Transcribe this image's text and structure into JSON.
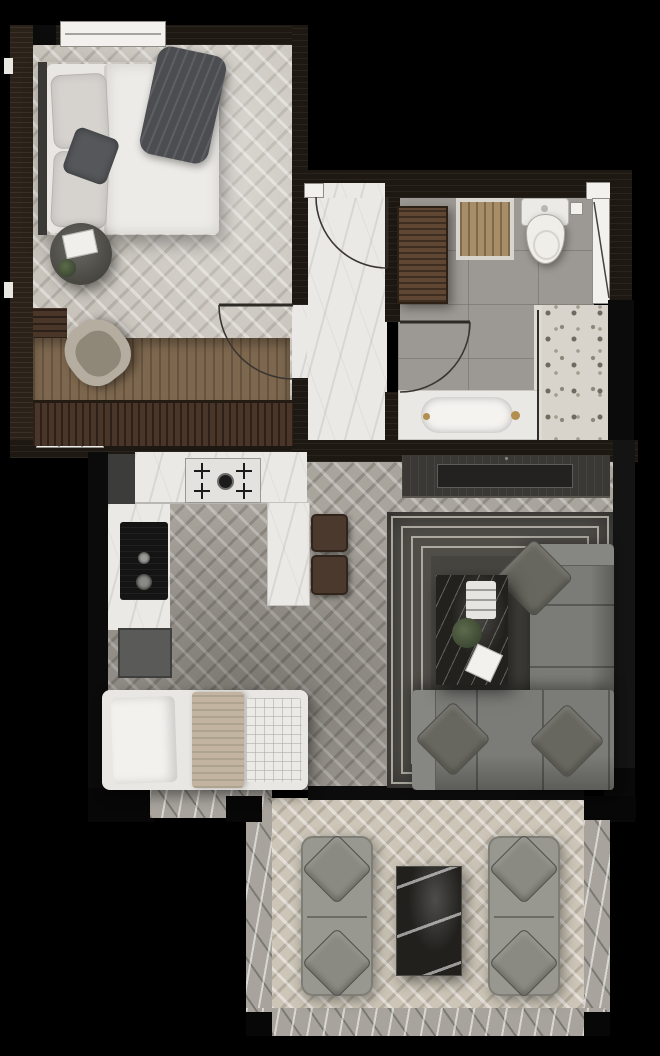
{
  "canvas": {
    "width": 660,
    "height": 1056
  },
  "plan_type": "apartment-floor-plan-top-view",
  "colors": {
    "background": "#000000",
    "wall": "#1e1813",
    "wall_black": "#0b0b0b",
    "floor_bedroom": "#c8c3bb",
    "floor_living": "#a9a49c",
    "floor_balcony": "#cdc6b8",
    "marble_white": "#eae9e6",
    "marble_grey": "#a8a49d",
    "tile_grey": "#9c9893",
    "terrazzo": "#d8d4cc",
    "wood_dark": "#4a3628",
    "wood_mid": "#5f4734",
    "wood_light": "#7d674e",
    "bed_white": "#e9e7e3",
    "linen": "#d6d3cf",
    "blanket_dark": "#4b4d50",
    "throw_tan": "#c2b4a1",
    "sofa_grey": "#7b7b77",
    "sofa_light": "#999890",
    "rug_dark": "#504e49",
    "rug_line": "#c4c0b7",
    "stone_dark": "#22211d",
    "stool_brown": "#4a392c",
    "chair_beige": "#b5ad9f",
    "plant_green": "#5c6b4b",
    "brass": "#b28e50",
    "counter_grey": "#5a5a58",
    "steel": "#3c3c3a"
  },
  "rooms": {
    "bedroom": {
      "floor": "light-herringbone-wood",
      "furniture": [
        "double-bed",
        "pillows",
        "dark-throw-blanket",
        "round-side-table",
        "plant",
        "book",
        "desk-chair",
        "desk",
        "dresser-wardrobe",
        "window"
      ]
    },
    "hallway": {
      "floor": "white-marble",
      "furniture": [
        "entry-door"
      ]
    },
    "bathroom": {
      "floor": "grey-tile",
      "furniture": [
        "toilet",
        "wooden-bath-mat",
        "storage-cabinet",
        "bathtub",
        "walk-in-shower-terrazzo",
        "window",
        "door"
      ]
    },
    "kitchen": {
      "floor": "grey-herringbone-wood",
      "furniture": [
        "gas-cooktop",
        "counter",
        "sink",
        "island",
        "bar-stool",
        "bar-stool",
        "grey-cabinet"
      ]
    },
    "living_room": {
      "floor": "grey-herringbone-wood",
      "furniture": [
        "tv-console",
        "striped-area-rug",
        "corner-sofa",
        "throw-pillows",
        "marble-coffee-table",
        "daybed"
      ]
    },
    "balcony": {
      "floor": "beige-herringbone-tile",
      "furniture": [
        "outdoor-sofa",
        "outdoor-sofa",
        "dark-marble-table",
        "marble-parapet"
      ]
    }
  }
}
